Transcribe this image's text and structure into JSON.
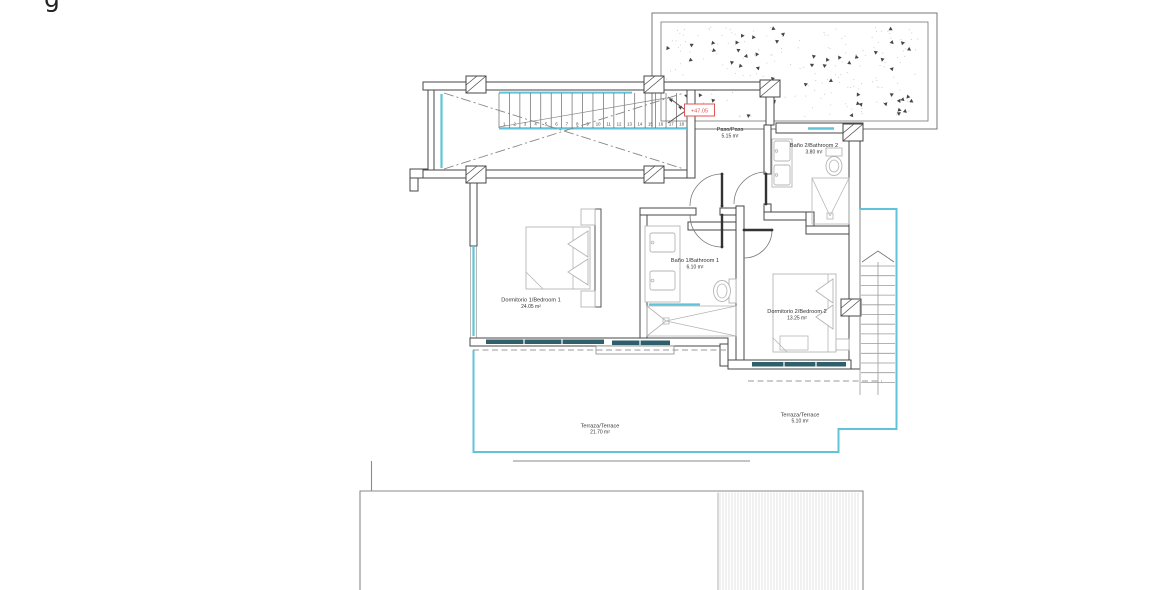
{
  "meta": {
    "cropped_text": "g"
  },
  "level_marker": {
    "value": "+47.05"
  },
  "colors": {
    "wall": "#474747",
    "glass_cyan": "#5fc4d9",
    "window_teal": "#2e5f6a",
    "accent_red": "#e05555"
  },
  "stairs": {
    "numbers": [
      "1",
      "2",
      "3",
      "4",
      "5",
      "6",
      "7",
      "8",
      "9",
      "10",
      "11",
      "12",
      "13",
      "14",
      "15",
      "16",
      "17",
      "18"
    ]
  },
  "rooms": {
    "paso": {
      "name": "Paso/Pass",
      "area": "5.15 m²"
    },
    "bano2": {
      "name": "Baño 2/Bathroom 2",
      "area": "3.80 m²"
    },
    "bano1": {
      "name": "Baño 1/Bathroom 1",
      "area": "6.10 m²"
    },
    "dormitorio1": {
      "name": "Dormitorio 1/Bedroom 1",
      "area": "24.05 m²"
    },
    "dormitorio2": {
      "name": "Dormitorio 2/Bedroom 2",
      "area": "13.25 m²"
    },
    "terraza1": {
      "name": "Terraza/Terrace",
      "area": "21.70 m²"
    },
    "terraza2": {
      "name": "Terraza/Terrace",
      "area": "5.10 m²"
    }
  }
}
